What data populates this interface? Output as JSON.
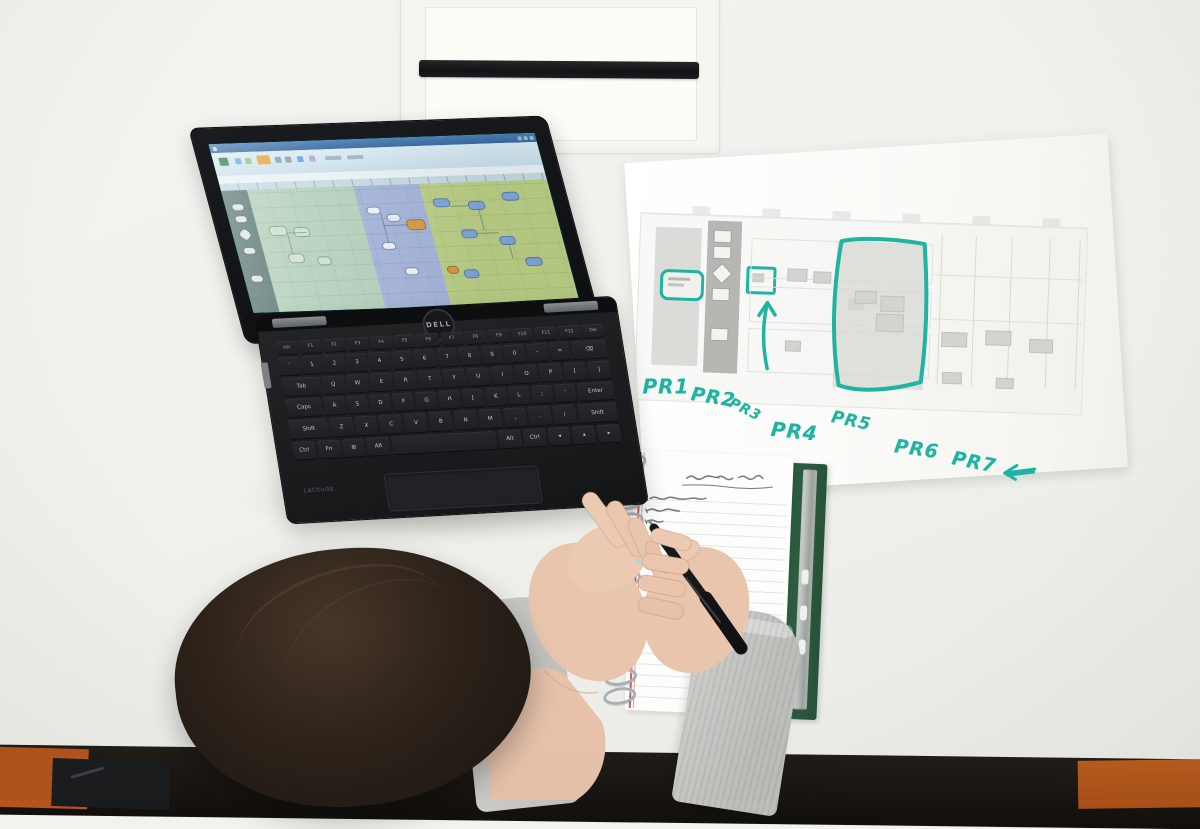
{
  "scene": {
    "type": "photograph",
    "view": "top-down office desk",
    "subjects": [
      "Dell laptop showing a process flow diagram in a spreadsheet",
      "printed process diagram annotated with teal marker",
      "spiral notebook with handwritten notes",
      "person writing with a black pen"
    ]
  },
  "desk": {
    "surface_color": "#f0f1ec",
    "front_shadow_color": "#15120f",
    "orange_corner_color": "#b4541c"
  },
  "cable_panel": {
    "body_color": "#f5f5f1",
    "slot_color": "#191a1c"
  },
  "laptop": {
    "brand_logo": "DELL",
    "model_label": "Latitude",
    "body_color": "#1a1c1e",
    "screen": {
      "app_type": "spreadsheet-process-diagram",
      "titlebar_color": "#3f74ac",
      "ribbon_color": "#d3e4ed",
      "lanes": [
        {
          "name": "dark-lane",
          "color": "#5e7a78"
        },
        {
          "name": "green-lane",
          "color": "#b3d0ba"
        },
        {
          "name": "blue-lane",
          "color": "#a4b4da"
        },
        {
          "name": "yellow-green-lane",
          "color": "#bccf85"
        }
      ],
      "node_color": "#7fa7d8",
      "highlight_node_color": "#d79a47"
    },
    "keyboard": {
      "rows": [
        [
          "esc",
          "F1",
          "F2",
          "F3",
          "F4",
          "F5",
          "F6",
          "F7",
          "F8",
          "F9",
          "F10",
          "F11",
          "F12",
          "Del"
        ],
        [
          "`",
          "1",
          "2",
          "3",
          "4",
          "5",
          "6",
          "7",
          "8",
          "9",
          "0",
          "-",
          "=",
          "⌫"
        ],
        [
          "Tab",
          "Q",
          "W",
          "E",
          "R",
          "T",
          "Y",
          "U",
          "I",
          "O",
          "P",
          "[",
          "]"
        ],
        [
          "Caps",
          "A",
          "S",
          "D",
          "F",
          "G",
          "H",
          "J",
          "K",
          "L",
          ";",
          "'",
          "Enter"
        ],
        [
          "Shift",
          "Z",
          "X",
          "C",
          "V",
          "B",
          "N",
          "M",
          ",",
          ".",
          "/",
          "Shift"
        ],
        [
          "Ctrl",
          "Fn",
          "⊞",
          "Alt",
          "",
          "Alt",
          "Ctrl",
          "◂",
          "▴",
          "▸"
        ]
      ],
      "wide_keys": [
        "Tab",
        "Caps",
        "Enter",
        "Shift",
        "⌫"
      ]
    }
  },
  "paper": {
    "labels": [
      "PR1",
      "PR2",
      "PR3",
      "PR4",
      "PR5",
      "PR6",
      "PR7"
    ],
    "marker_color": "#1fb3a2",
    "marks": [
      "circle-around-shape",
      "box-around-shape",
      "up-arrow",
      "hand-drawn-region-rectangle",
      "left-arrow"
    ]
  },
  "notebook": {
    "cover_color": "#2c5a40",
    "clip_color": "#b9bdb9",
    "page_color": "#fdfdfb",
    "ruled_line_color": "#dde2e8",
    "spiral_rings": 13,
    "handwriting": "illegible pen notes with underlined title"
  },
  "person": {
    "hair_color": "#2b211a",
    "sweater_color": "#c9cac6",
    "pen_color": "#1a1b1d",
    "accessory": "silver ring"
  }
}
